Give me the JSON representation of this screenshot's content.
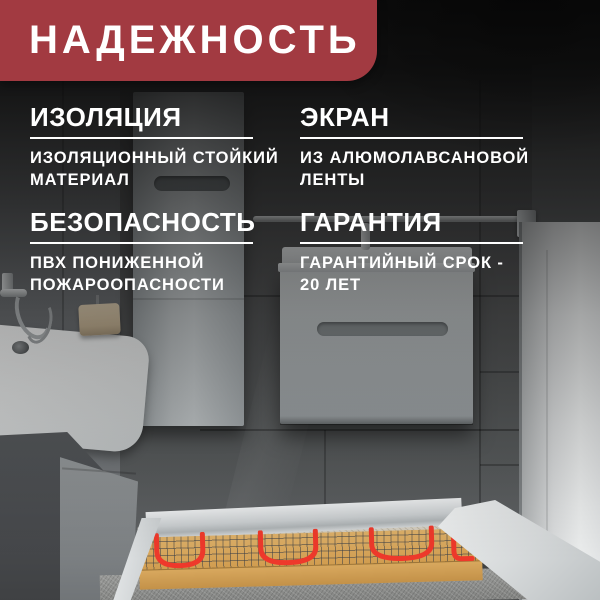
{
  "banner": {
    "title": "НАДЕЖНОСТЬ"
  },
  "features": [
    {
      "id": "insulation",
      "title": "ИЗОЛЯЦИЯ",
      "lines": [
        "ИЗОЛЯЦИОННЫЙ СТОЙКИЙ",
        "МАТЕРИАЛ"
      ]
    },
    {
      "id": "screen",
      "title": "ЭКРАН",
      "lines": [
        "ИЗ АЛЮМОЛАВСАНОВОЙ",
        "ЛЕНТЫ"
      ]
    },
    {
      "id": "safety",
      "title": "БЕЗОПАСНОСТЬ",
      "lines": [
        "ПВХ ПОНИЖЕННОЙ",
        "ПОЖАРООПАСНОСТИ"
      ]
    },
    {
      "id": "warranty",
      "title": "ГАРАНТИЯ",
      "lines": [
        "ГАРАНТИЙНЫЙ СРОК -",
        "20 ЛЕТ"
      ]
    }
  ],
  "colors": {
    "banner_bg": "#a23a41",
    "text": "#ffffff",
    "heating_cable": "#ee392b",
    "heating_mat": "#d8a75d"
  },
  "scene": {
    "subject": "bathroom with underfloor heating mat"
  }
}
